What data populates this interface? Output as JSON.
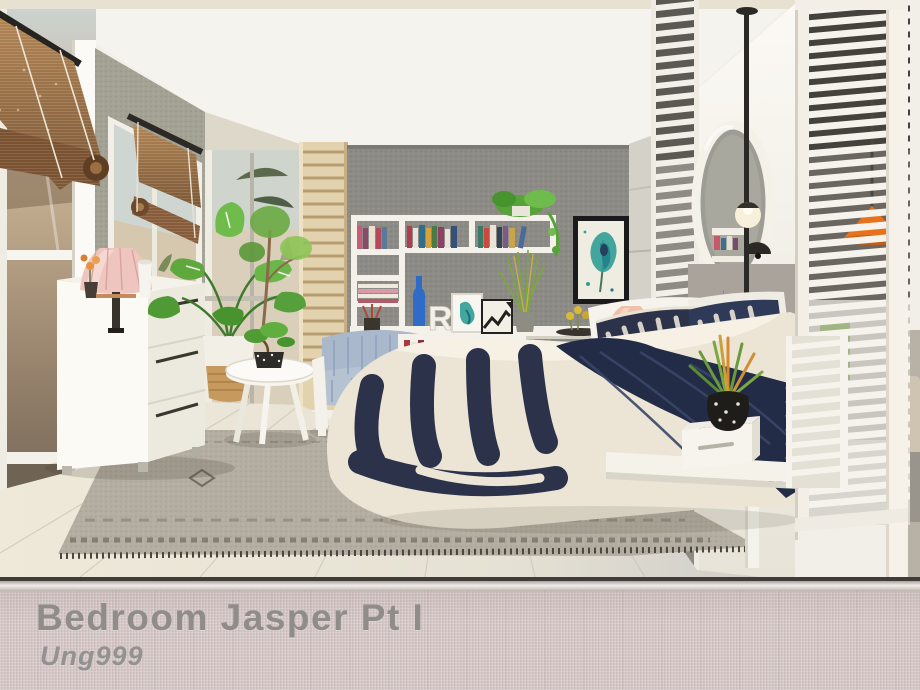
{
  "banner": {
    "title": "Bedroom Jasper Pt I",
    "author": "Ung999",
    "background": "#d2c4c3",
    "text_color": "#8f8c8a"
  },
  "scene": {
    "decor_letter": "R",
    "palette": {
      "ceiling": "#f2efe9",
      "accent_wall": "#8d8b85",
      "left_wall": "#a3a294",
      "floor_left": "#ece7d8",
      "floor_right": "#cbc8c3",
      "bedding_navy": "#2b3249",
      "bedding_cream": "#ece5d6",
      "rug": "#b4ada1",
      "bamboo_blind": "#a97f52",
      "plant_green": "#5ea83e",
      "cobalt_accent": "#2e6cc8",
      "teal_art": "#2f9e96",
      "orange_lamp": "#e8721c",
      "peach_lamp": "#f0c0a8",
      "white_furniture": "#f6f3ec"
    }
  }
}
